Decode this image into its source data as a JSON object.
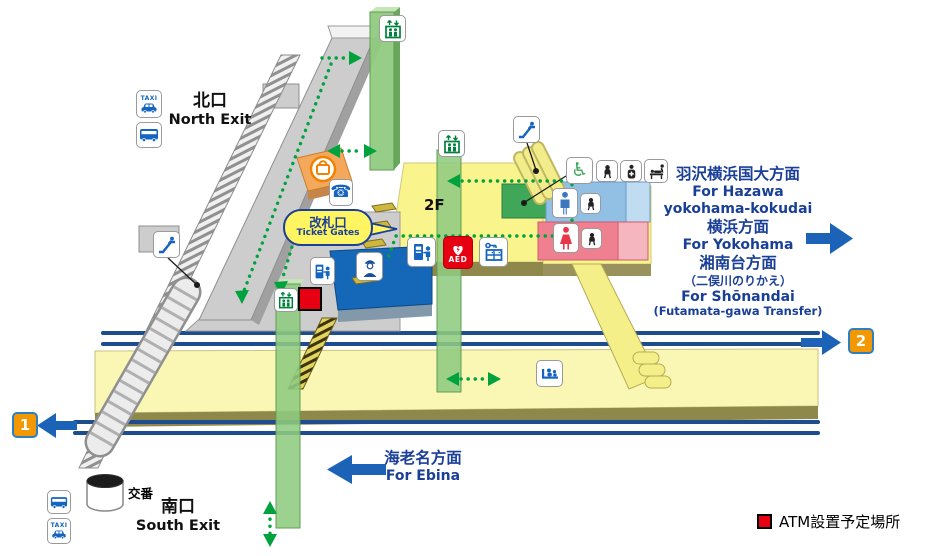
{
  "colors": {
    "navy": "#1a3f97",
    "route_green": "#00a23e",
    "track_blue": "#1d4d8f",
    "arrow_blue": "#1c63b7",
    "aed_red": "#e60012",
    "platform_orange": "#f39800",
    "icon_blue": "#1565c0",
    "toilet_green": "#3fa757",
    "man_blue": "#3b76c0",
    "woman_red": "#e8374a",
    "floor_yellow": "#f9f58c",
    "platform_yellow": "#faf7b4",
    "elevator_green": "#90cb81"
  },
  "exits": {
    "north_jp": "北口",
    "north_en": "North Exit",
    "south_jp": "南口",
    "south_en": "South Exit"
  },
  "labels": {
    "taxi": "TAXI",
    "aed": "AED",
    "floor": "2F",
    "koban": "交番",
    "ticket_gates_jp": "改札口",
    "ticket_gates_en": "Ticket Gates"
  },
  "directions": {
    "hazawa_jp": "羽沢横浜国大方面",
    "hazawa_en_1": "For Hazawa",
    "hazawa_en_2": "yokohama-kokudai",
    "yokohama_jp": "横浜方面",
    "yokohama_en": "For Yokohama",
    "shonandai_jp": "湘南台方面",
    "shonandai_note_jp": "（二俣川のりかえ）",
    "shonandai_en": "For Shōnandai",
    "shonandai_note_en": "(Futamata-gawa Transfer)",
    "ebina_jp": "海老名方面",
    "ebina_en": "For Ebina"
  },
  "platforms": {
    "one": "1",
    "two": "2"
  },
  "legend": {
    "atm_label": "ATM設置予定場所"
  },
  "icons": {
    "phone_glyph": "☎",
    "wheelchair_glyph": "♿",
    "names": [
      "taxi-icon",
      "bus-icon",
      "escalator-icon",
      "elevator-icon",
      "phone-icon",
      "kiosk-icon",
      "ticket-machine-icon",
      "aed-icon",
      "coin-locker-icon",
      "station-staff-icon",
      "mens-toilet-icon",
      "womens-toilet-icon",
      "baby-seat-icon",
      "ostomate-icon",
      "diaper-changing-icon",
      "bench-icon",
      "atm-planned-marker",
      "police-box"
    ]
  }
}
